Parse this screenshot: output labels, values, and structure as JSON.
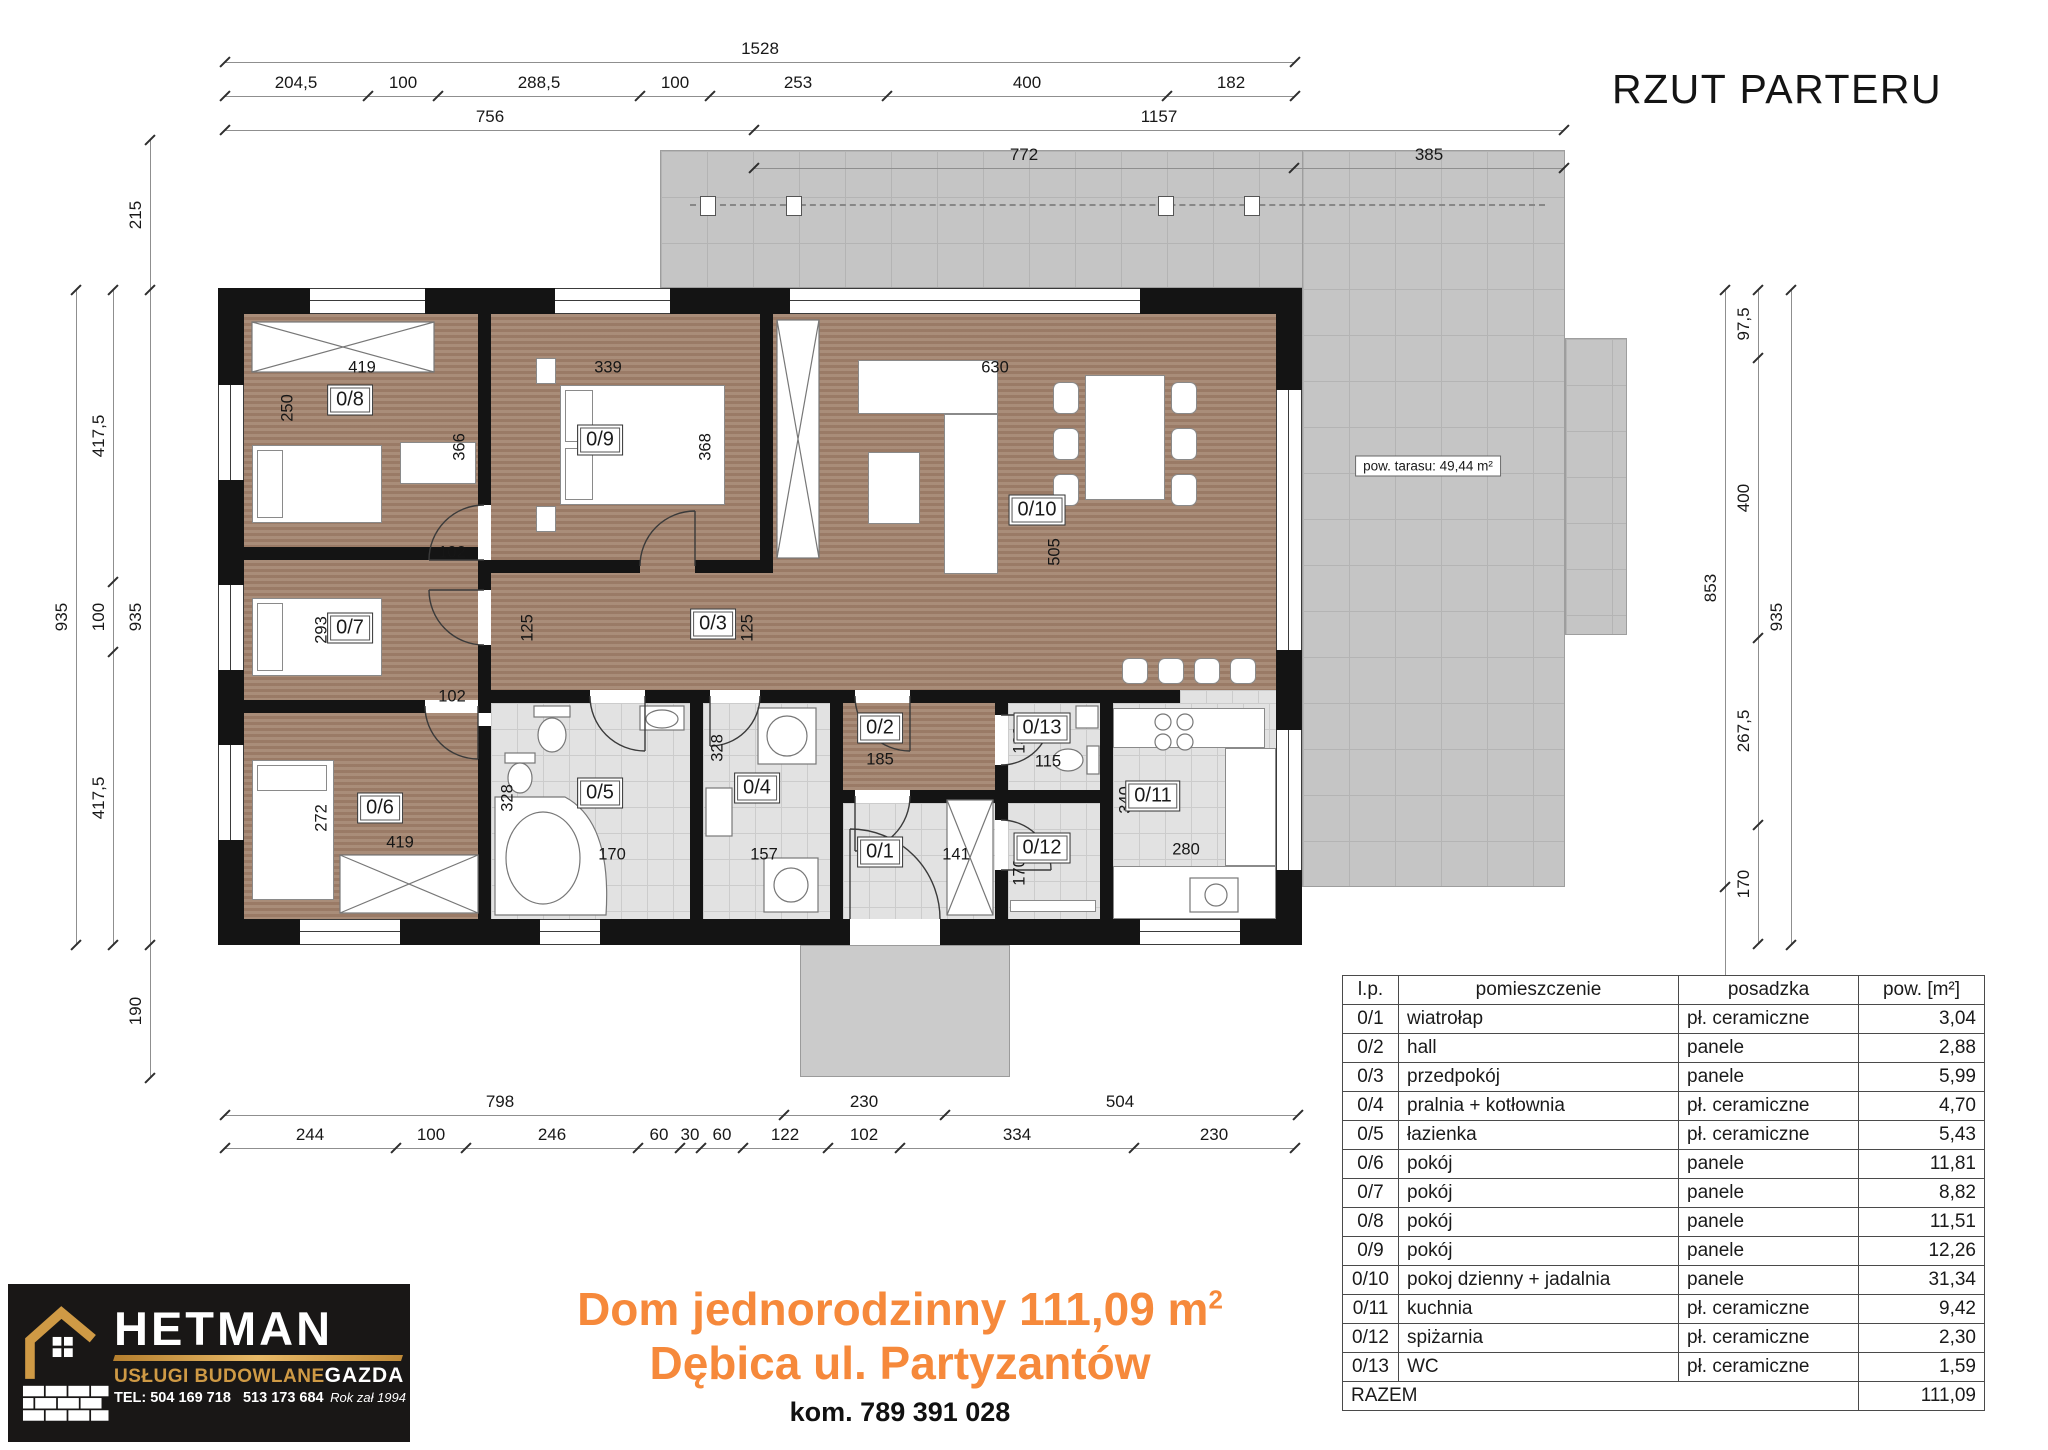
{
  "title": "RZUT PARTERU",
  "terrace_label": "pow. tarasu: 49,44 m²",
  "footer": {
    "line1": "Dom jednorodzinny 111,09 m",
    "line1_sup": "2",
    "line2": "Dębica ul. Partyzantów",
    "line3": "kom. 789 391 028"
  },
  "logo": {
    "brand": "HETMAN",
    "tagline": "USŁUGI BUDOWLANE",
    "company": "GAZDA",
    "tel": "TEL: 504 169 718",
    "tel2": "513 173 684",
    "established": "Rok zał 1994",
    "gold": "#cf9a45"
  },
  "table": {
    "headers": [
      "l.p.",
      "pomieszczenie",
      "posadzka",
      "pow. [m²]"
    ],
    "rows": [
      {
        "lp": "0/1",
        "name": "wiatrołap",
        "floor": "pł. ceramiczne",
        "area": "3,04",
        "bold": false
      },
      {
        "lp": "0/2",
        "name": "hall",
        "floor": "panele",
        "area": "2,88",
        "bold": false
      },
      {
        "lp": "0/3",
        "name": "przedpokój",
        "floor": "panele",
        "area": "5,99",
        "bold": false
      },
      {
        "lp": "0/4",
        "name": "pralnia + kotłownia",
        "floor": "pł. ceramiczne",
        "area": "4,70",
        "bold": false
      },
      {
        "lp": "0/5",
        "name": "łazienka",
        "floor": "pł. ceramiczne",
        "area": "5,43",
        "bold": false
      },
      {
        "lp": "0/6",
        "name": "pokój",
        "floor": "panele",
        "area": "11,81",
        "bold": true
      },
      {
        "lp": "0/7",
        "name": "pokój",
        "floor": "panele",
        "area": "8,82",
        "bold": false
      },
      {
        "lp": "0/8",
        "name": "pokój",
        "floor": "panele",
        "area": "11,51",
        "bold": false
      },
      {
        "lp": "0/9",
        "name": "pokój",
        "floor": "panele",
        "area": "12,26",
        "bold": false
      },
      {
        "lp": "0/10",
        "name": "pokoj dzienny + jadalnia",
        "floor": "panele",
        "area": "31,34",
        "bold": false
      },
      {
        "lp": "0/11",
        "name": "kuchnia",
        "floor": "pł. ceramiczne",
        "area": "9,42",
        "bold": false
      },
      {
        "lp": "0/12",
        "name": "spiżarnia",
        "floor": "pł. ceramiczne",
        "area": "2,30",
        "bold": false
      },
      {
        "lp": "0/13",
        "name": "WC",
        "floor": "pł. ceramiczne",
        "area": "1,59",
        "bold": false
      }
    ],
    "total_label": "RAZEM",
    "total_value": "111,09"
  },
  "plan": {
    "room_labels": [
      {
        "id": "0/8",
        "x": 350,
        "y": 400
      },
      {
        "id": "0/9",
        "x": 600,
        "y": 440
      },
      {
        "id": "0/10",
        "x": 1037,
        "y": 510
      },
      {
        "id": "0/7",
        "x": 350,
        "y": 628
      },
      {
        "id": "0/3",
        "x": 713,
        "y": 624
      },
      {
        "id": "0/6",
        "x": 380,
        "y": 808
      },
      {
        "id": "0/5",
        "x": 600,
        "y": 793
      },
      {
        "id": "0/4",
        "x": 757,
        "y": 788
      },
      {
        "id": "0/2",
        "x": 880,
        "y": 728
      },
      {
        "id": "0/1",
        "x": 880,
        "y": 852
      },
      {
        "id": "0/13",
        "x": 1042,
        "y": 728
      },
      {
        "id": "0/12",
        "x": 1042,
        "y": 848
      },
      {
        "id": "0/11",
        "x": 1153,
        "y": 796
      }
    ],
    "floating_dims": [
      {
        "t": "419",
        "x": 362,
        "y": 368
      },
      {
        "t": "250",
        "x": 288,
        "y": 408,
        "r": 1
      },
      {
        "t": "339",
        "x": 608,
        "y": 368
      },
      {
        "t": "366",
        "x": 460,
        "y": 447,
        "r": 1
      },
      {
        "t": "368",
        "x": 706,
        "y": 447,
        "r": 1
      },
      {
        "t": "630",
        "x": 995,
        "y": 368
      },
      {
        "t": "505",
        "x": 1055,
        "y": 552,
        "r": 1
      },
      {
        "t": "102",
        "x": 452,
        "y": 553
      },
      {
        "t": "293",
        "x": 322,
        "y": 630,
        "r": 1
      },
      {
        "t": "125",
        "x": 528,
        "y": 628,
        "r": 1
      },
      {
        "t": "125",
        "x": 748,
        "y": 628,
        "r": 1
      },
      {
        "t": "102",
        "x": 452,
        "y": 697
      },
      {
        "t": "272",
        "x": 322,
        "y": 818,
        "r": 1
      },
      {
        "t": "419",
        "x": 400,
        "y": 843
      },
      {
        "t": "328",
        "x": 508,
        "y": 798,
        "r": 1
      },
      {
        "t": "170",
        "x": 612,
        "y": 855
      },
      {
        "t": "328",
        "x": 718,
        "y": 748,
        "r": 1
      },
      {
        "t": "157",
        "x": 764,
        "y": 855
      },
      {
        "t": "185",
        "x": 880,
        "y": 760
      },
      {
        "t": "185",
        "x": 886,
        "y": 855
      },
      {
        "t": "141",
        "x": 956,
        "y": 855
      },
      {
        "t": "133",
        "x": 1020,
        "y": 740,
        "r": 1
      },
      {
        "t": "115",
        "x": 1048,
        "y": 762
      },
      {
        "t": "170",
        "x": 1020,
        "y": 872,
        "r": 1
      },
      {
        "t": "340",
        "x": 1126,
        "y": 800,
        "r": 1
      },
      {
        "t": "280",
        "x": 1186,
        "y": 850
      }
    ]
  },
  "dims": {
    "h_rows": [
      {
        "y": 62,
        "xs": [
          225,
          1295
        ],
        "labels": [
          {
            "t": "1528",
            "p": 760
          }
        ]
      },
      {
        "y": 96,
        "xs": [
          225,
          368,
          438,
          640,
          710,
          887,
          1167,
          1295
        ],
        "labels": [
          {
            "t": "204,5",
            "p": 296
          },
          {
            "t": "100",
            "p": 403
          },
          {
            "t": "288,5",
            "p": 539
          },
          {
            "t": "100",
            "p": 675
          },
          {
            "t": "253",
            "p": 798
          },
          {
            "t": "400",
            "p": 1027
          },
          {
            "t": "182",
            "p": 1231
          }
        ]
      },
      {
        "y": 130,
        "xs": [
          225,
          754,
          1564
        ],
        "labels": [
          {
            "t": "756",
            "p": 490
          },
          {
            "t": "1157",
            "p": 1159
          }
        ]
      },
      {
        "y": 168,
        "xs": [
          754,
          1294,
          1564
        ],
        "labels": [
          {
            "t": "772",
            "p": 1024
          },
          {
            "t": "385",
            "p": 1429
          }
        ]
      },
      {
        "y": 1115,
        "xs": [
          225,
          784,
          945,
          1298
        ],
        "labels": [
          {
            "t": "798",
            "p": 500
          },
          {
            "t": "230",
            "p": 864
          },
          {
            "t": "504",
            "p": 1120
          }
        ]
      },
      {
        "y": 1148,
        "xs": [
          225,
          396,
          466,
          638,
          680,
          701,
          743,
          828,
          900,
          1134,
          1295
        ],
        "labels": [
          {
            "t": "244",
            "p": 310
          },
          {
            "t": "100",
            "p": 431
          },
          {
            "t": "246",
            "p": 552
          },
          {
            "t": "60",
            "p": 659
          },
          {
            "t": "30",
            "p": 690
          },
          {
            "t": "60",
            "p": 722
          },
          {
            "t": "122",
            "p": 785
          },
          {
            "t": "102",
            "p": 864
          },
          {
            "t": "334",
            "p": 1017
          },
          {
            "t": "230",
            "p": 1214
          }
        ]
      }
    ],
    "v_cols": [
      {
        "x": 150,
        "ys": [
          140,
          290,
          945,
          1078
        ],
        "labels": [
          {
            "t": "215",
            "p": 215
          },
          {
            "t": "935",
            "p": 617
          },
          {
            "t": "190",
            "p": 1011
          }
        ]
      },
      {
        "x": 113,
        "ys": [
          290,
          582,
          652,
          945
        ],
        "labels": [
          {
            "t": "417,5",
            "p": 436
          },
          {
            "t": "100",
            "p": 617
          },
          {
            "t": "417,5",
            "p": 798
          }
        ]
      },
      {
        "x": 76,
        "ys": [
          290,
          945
        ],
        "labels": [
          {
            "t": "935",
            "p": 617
          }
        ]
      },
      {
        "x": 1725,
        "ys": [
          290,
          887,
          1095
        ],
        "labels": [
          {
            "t": "853",
            "p": 588
          },
          {
            "t": "297",
            "p": 991
          }
        ]
      },
      {
        "x": 1758,
        "ys": [
          290,
          358,
          638,
          825,
          944
        ],
        "labels": [
          {
            "t": "97,5",
            "p": 324
          },
          {
            "t": "400",
            "p": 498
          },
          {
            "t": "267,5",
            "p": 731
          },
          {
            "t": "170",
            "p": 884
          }
        ]
      },
      {
        "x": 1791,
        "ys": [
          290,
          945
        ],
        "labels": [
          {
            "t": "935",
            "p": 617
          }
        ]
      }
    ]
  }
}
